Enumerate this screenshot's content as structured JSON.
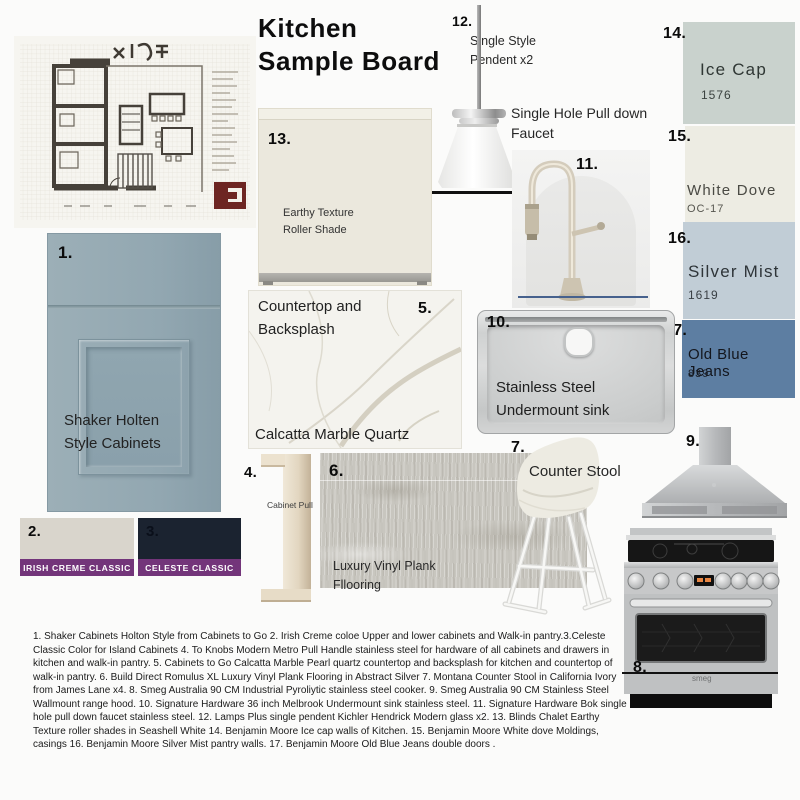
{
  "title": {
    "line1": "Kitchen",
    "line2": "Sample Board"
  },
  "items": {
    "cabinets": {
      "num": "1.",
      "line1": "Shaker Holten",
      "line2": "Style Cabinets"
    },
    "irish_creme": {
      "num": "2.",
      "label": "IRISH CREME CLASSIC",
      "swatch_color": "#d9d5cc",
      "label_bg": "#73357a"
    },
    "celeste": {
      "num": "3.",
      "label": "CELESTE CLASSIC",
      "swatch_color": "#1b2330",
      "label_bg": "#73357a"
    },
    "cabinet_pull": {
      "num": "4.",
      "label": "Cabinet Pull"
    },
    "countertop": {
      "num": "5.",
      "line1": "Countertop and",
      "line2": "Backsplash",
      "caption": "Calcatta Marble Quartz"
    },
    "flooring": {
      "num": "6.",
      "line1": "Luxury Vinyl Plank",
      "line2": "Fllooring"
    },
    "stool": {
      "num": "7.",
      "label": "Counter Stool"
    },
    "range": {
      "num": "8.",
      "brand": "smeg"
    },
    "hood": {
      "num": "9."
    },
    "sink": {
      "num": "10.",
      "line1": "Stainless Steel",
      "line2": "Undermount sink"
    },
    "faucet": {
      "num": "11.",
      "line1": "Single Hole Pull down",
      "line2": "Faucet"
    },
    "pendant": {
      "num": "12.",
      "line1": "Single Style",
      "line2": "Pendent x2"
    },
    "roller_shade": {
      "num": "13.",
      "line1": "Earthy Texture",
      "line2": "Roller Shade"
    }
  },
  "paints": [
    {
      "num": "14.",
      "name": "Ice Cap",
      "code": "1576",
      "color": "#c9d2cd"
    },
    {
      "num": "15.",
      "name": "White Dove",
      "code": "OC-17",
      "color": "#edece3"
    },
    {
      "num": "16.",
      "name": "Silver Mist",
      "code": "1619",
      "color": "#c1cdd6"
    },
    {
      "num": "17.",
      "name": "Old Blue Jeans",
      "code": "839",
      "color": "#5d7ea2"
    }
  ],
  "footnote": "1. Shaker Cabinets Holton Style  from Cabinets to Go 2. Irish Creme coloe Upper and lower cabinets and Walk-in pantry.3.Celeste Classic Color for Island Cabinets 4. To Knobs Modern Metro Pull Handle stainless steel for hardware of all cabinets and drawers in kitchen and walk-in pantry. 5. Cabinets to Go Calcatta Marble Pearl quartz countertop and backsplash for kitchen and countertop of walk-in pantry. 6. Build Direct Romulus XL Luxury Vinyl Plank Flooring in Abstract Silver 7. Montana Counter Stool in California Ivory from James Lane x4. 8. Smeg Australia 90 CM Industrial Pyroliytic stainless steel cooker. 9. Smeg Australia 90 CM Stainless Steel Wallmount range hood. 10. Signature Hardware 36 inch Melbrook Undermount sink stainless steel. 11. Signature Hardware Bok single hole pull down faucet stainless steel. 12. Lamps Plus single pendent Kichler Hendrick Modern glass x2. 13. Blinds Chalet Earthy Texture roller shades in Seashell White 14. Benjamin Moore Ice cap walls of Kitchen. 15. Benjamin Moore White dove Moldings, casings 16. Benjamin Moore Silver Mist pantry walls. 17. Benjamin Moore Old Blue Jeans double doors ."
}
